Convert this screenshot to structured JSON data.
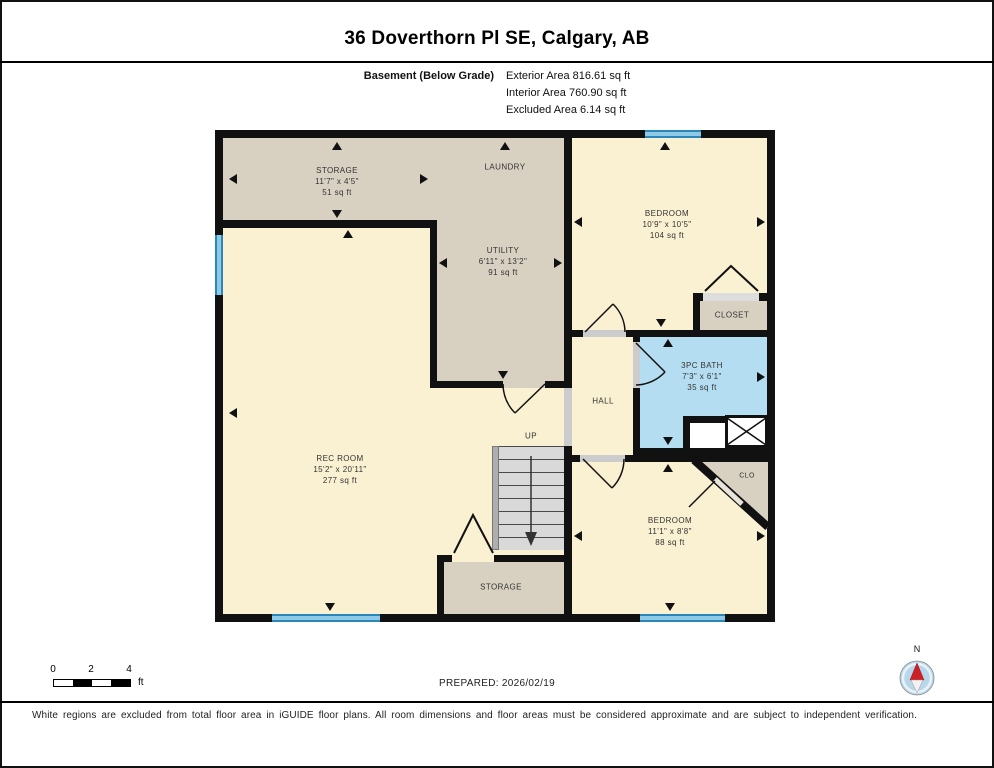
{
  "title": "36 Doverthorn Pl SE, Calgary, AB",
  "subtitle": {
    "floor": "Basement (Below Grade)",
    "exterior": "Exterior Area 816.61 sq ft",
    "interior": "Interior Area 760.90 sq ft",
    "excluded": "Excluded Area 6.14 sq ft"
  },
  "rooms": {
    "storage_top": {
      "name": "STORAGE",
      "dims": "11'7\" x 4'5\"",
      "area": "51 sq ft"
    },
    "laundry": {
      "name": "LAUNDRY"
    },
    "utility": {
      "name": "UTILITY",
      "dims": "6'11\" x 13'2\"",
      "area": "91 sq ft"
    },
    "bedroom_top": {
      "name": "BEDROOM",
      "dims": "10'9\" x 10'5\"",
      "area": "104 sq ft"
    },
    "closet": {
      "name": "CLOSET"
    },
    "bath": {
      "name": "3PC BATH",
      "dims": "7'3\" x 6'1\"",
      "area": "35 sq ft"
    },
    "hall": {
      "name": "HALL"
    },
    "stairs": {
      "label": "UP"
    },
    "rec_room": {
      "name": "REC ROOM",
      "dims": "15'2\" x 20'11\"",
      "area": "277 sq ft"
    },
    "bedroom_bottom": {
      "name": "BEDROOM",
      "dims": "11'1\" x 8'8\"",
      "area": "88 sq ft"
    },
    "clo": {
      "name": "CLO"
    },
    "storage_bottom": {
      "name": "STORAGE"
    }
  },
  "footer": {
    "scale": {
      "t0": "0",
      "t1": "2",
      "t2": "4",
      "unit": "ft"
    },
    "prepared": "PREPARED: 2026/02/19",
    "compass": "N",
    "disclaimer": "White regions are excluded from total floor area in iGUIDE floor plans. All room dimensions and floor areas must be considered approximate and are subject to independent verification."
  },
  "colors": {
    "wall": "#111111",
    "room_cream": "#faf0d2",
    "room_beige": "#d8d0c1",
    "bath_blue": "#b5ddf2",
    "window_blue": "#8ecae6",
    "stairs_gray": "#d9d9d9"
  }
}
